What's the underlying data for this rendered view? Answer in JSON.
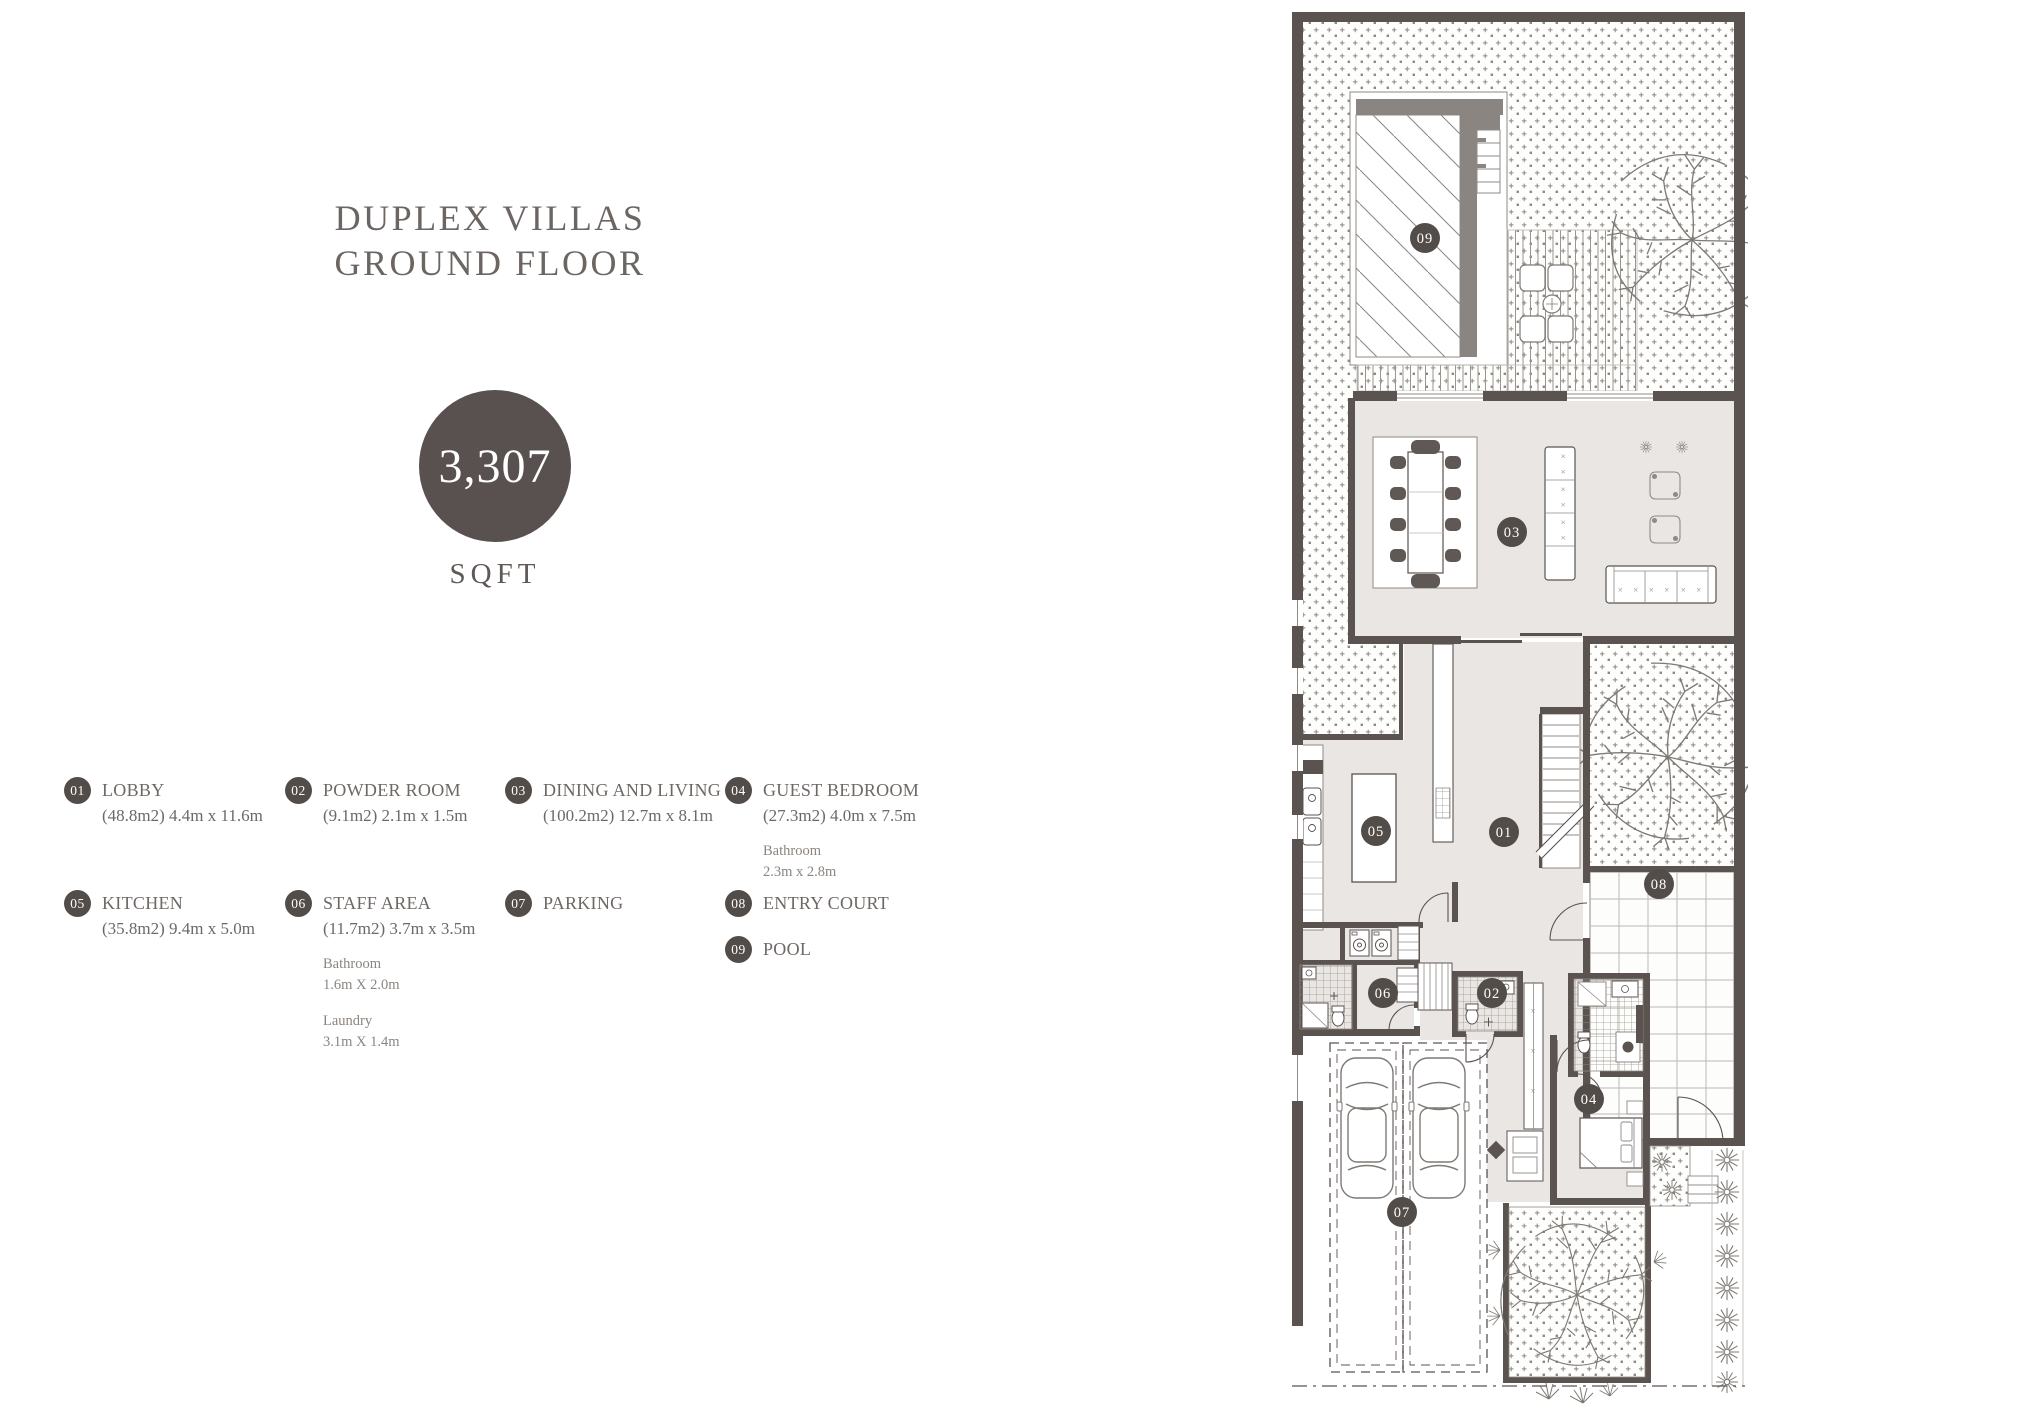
{
  "title": {
    "line1": "DUPLEX VILLAS",
    "line2": "GROUND FLOOR"
  },
  "area_badge": {
    "value": "3,307",
    "unit": "SQFT"
  },
  "legend": {
    "items": [
      {
        "num": "01",
        "label": "LOBBY",
        "dims": "(48.8m2) 4.4m x 11.6m"
      },
      {
        "num": "02",
        "label": "POWDER ROOM",
        "dims": "(9.1m2) 2.1m x 1.5m"
      },
      {
        "num": "03",
        "label": "DINING AND LIVING",
        "dims": "(100.2m2) 12.7m x 8.1m"
      },
      {
        "num": "04",
        "label": "GUEST BEDROOM",
        "dims": "(27.3m2) 4.0m x 7.5m",
        "extras": [
          {
            "name": "Bathroom",
            "dims": "2.3m x 2.8m"
          }
        ]
      },
      {
        "num": "05",
        "label": "KITCHEN",
        "dims": "(35.8m2) 9.4m x 5.0m"
      },
      {
        "num": "06",
        "label": "STAFF AREA",
        "dims": "(11.7m2) 3.7m x 3.5m",
        "extras": [
          {
            "name": "Bathroom",
            "dims": "1.6m X 2.0m"
          },
          {
            "name": "Laundry",
            "dims": "3.1m X 1.4m"
          }
        ]
      },
      {
        "num": "07",
        "label": "PARKING"
      },
      {
        "num": "08",
        "label": "ENTRY COURT"
      },
      {
        "num": "09",
        "label": "POOL"
      }
    ]
  },
  "plan": {
    "badges": [
      {
        "id": "01"
      },
      {
        "id": "02"
      },
      {
        "id": "03"
      },
      {
        "id": "04"
      },
      {
        "id": "05"
      },
      {
        "id": "06"
      },
      {
        "id": "07"
      },
      {
        "id": "08"
      },
      {
        "id": "09"
      }
    ]
  },
  "colors": {
    "badge": "#534d4a",
    "wall": "#5b5350",
    "floor": "#e9e6e3",
    "title_text": "#6c6663",
    "legend_text": "#6e6864",
    "muted_text": "#8b8580"
  }
}
